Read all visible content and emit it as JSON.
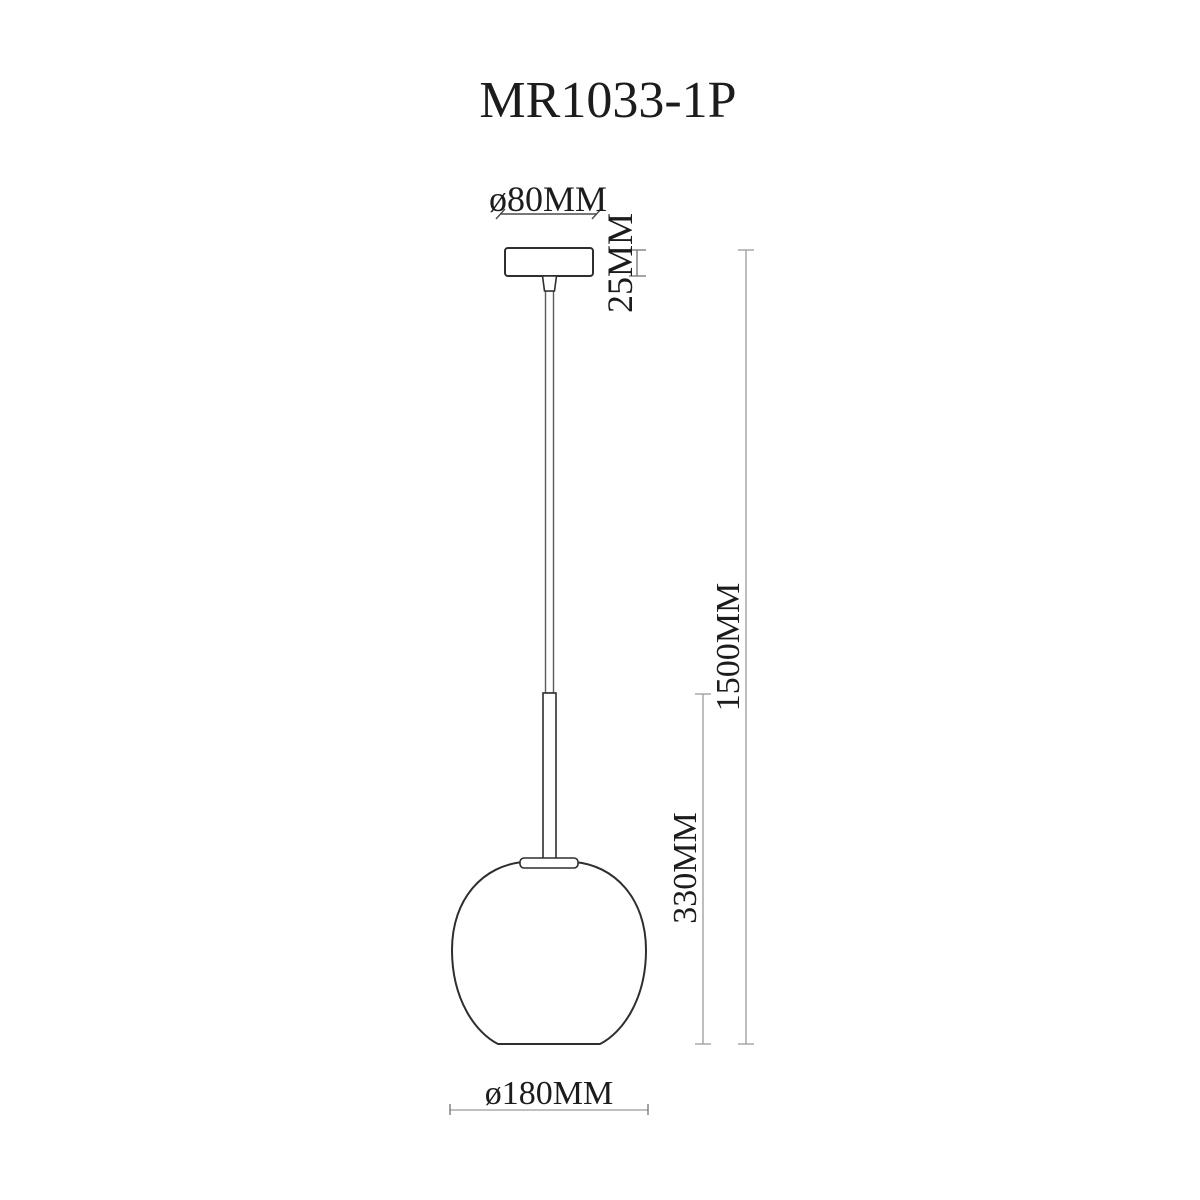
{
  "page": {
    "background": "#ffffff"
  },
  "drawing": {
    "title": "MR1033-1P",
    "labels": {
      "canopy_diameter": "ø80MM",
      "canopy_height": "25MM",
      "overall_drop": "1500MM",
      "shade_drop": "330MM",
      "shade_diameter": "ø180MM"
    },
    "colors": {
      "background": "#ffffff",
      "object_stroke": "#2e2e2e",
      "wire_stroke": "#5a5a5a",
      "dim_dark": "#4a4a4a",
      "dim_mid": "#6f6f6f",
      "dim_light": "#9a9a9a",
      "text": "#1c1c1c"
    }
  }
}
